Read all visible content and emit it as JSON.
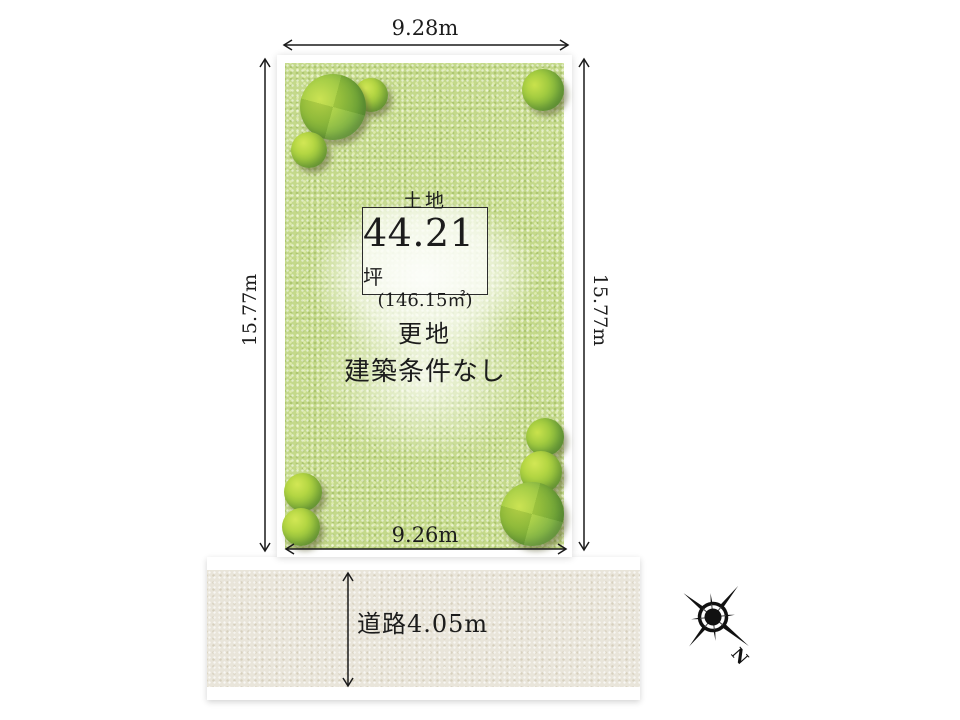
{
  "plot": {
    "dim_top": "9.28m",
    "dim_bottom": "9.26m",
    "dim_left": "15.77m",
    "dim_right": "15.77m",
    "land_box": {
      "category": "土地",
      "area_value": "44.21",
      "area_unit": "坪",
      "area_alt": "(146.15㎡)"
    },
    "status": [
      "更地",
      "建築条件なし"
    ]
  },
  "road": {
    "label": "道路4.05m"
  },
  "compass": {
    "north": "N"
  },
  "colors": {
    "field_green": "#c4d98b",
    "tree_green": "#8abb3a",
    "road_beige": "#e9e5da",
    "ink": "#1c1c1c"
  }
}
